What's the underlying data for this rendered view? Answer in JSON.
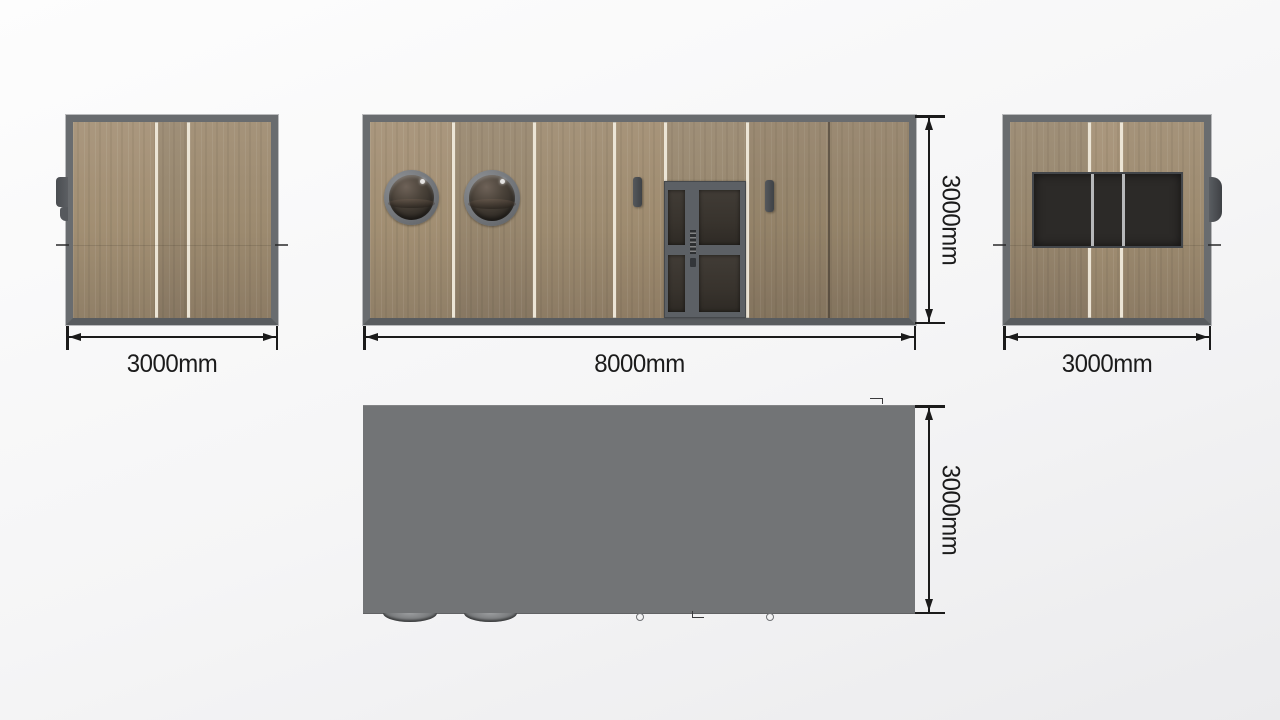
{
  "dimensions": {
    "left_view_width": "3000mm",
    "front_view_width": "8000mm",
    "front_view_height": "3000mm",
    "right_view_width": "3000mm",
    "top_view_depth": "3000mm"
  },
  "colors": {
    "frame": "#696c6f",
    "frame-dark": "#595c5f",
    "wood": "#9c8a6f",
    "wood-light": "#a5937a",
    "wood-dark": "#8c7b64",
    "joint-white": "#ece5d6",
    "roof": "#727476",
    "glass": "#38332d",
    "door": "#5c6065",
    "hardware": "#46494d",
    "dim": "#1b1b1b",
    "bg-top": "#fdfdfd",
    "bg-bottom": "#ebebed"
  }
}
